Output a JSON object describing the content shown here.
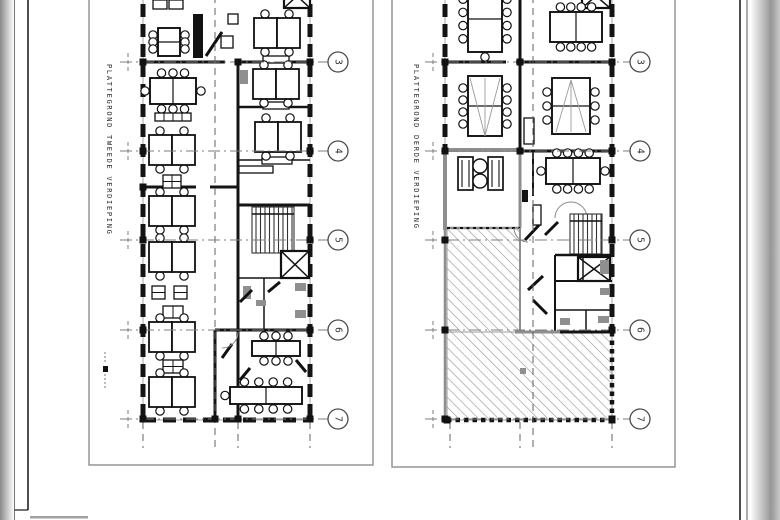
{
  "sheet": {
    "type": "architectural-floorplan-scan",
    "grid_labels": [
      "3",
      "4",
      "5",
      "6",
      "7"
    ]
  },
  "plans": [
    {
      "title": "PLATTEGROND TWEEDE VERDIEPING",
      "frame": {
        "x": 89,
        "y": -16,
        "w": 284,
        "h": 481
      },
      "title_pos": {
        "x": 107,
        "y": 64
      },
      "grid": {
        "ys": [
          62,
          151,
          240,
          330,
          419
        ],
        "labels": [
          "3",
          "4",
          "5",
          "6",
          "7"
        ],
        "x1": 120,
        "x2": 328,
        "bubble_x": 338,
        "tick_x": 128
      },
      "vdash": [
        [
          215,
          -16,
          215,
          448
        ],
        [
          143,
          422,
          143,
          448
        ],
        [
          238,
          422,
          238,
          448
        ],
        [
          310,
          422,
          310,
          448
        ]
      ],
      "nodes": [
        [
          143,
          62
        ],
        [
          310,
          62
        ],
        [
          143,
          151
        ],
        [
          310,
          151
        ],
        [
          143,
          240
        ],
        [
          310,
          240
        ],
        [
          143,
          330
        ],
        [
          310,
          330
        ],
        [
          143,
          419
        ],
        [
          310,
          419
        ],
        [
          238,
          62
        ],
        [
          238,
          419
        ],
        [
          215,
          419
        ],
        [
          143,
          187
        ]
      ],
      "items": [
        [
          "ww",
          143,
          -16,
          143,
          420
        ],
        [
          "ww",
          310,
          -16,
          310,
          420
        ],
        [
          "ww",
          143,
          420,
          310,
          420
        ],
        [
          "w",
          143,
          62,
          225,
          62,
          3
        ],
        [
          "w",
          236,
          62,
          310,
          62,
          3
        ],
        [
          "w",
          238,
          107,
          310,
          107,
          2.5
        ],
        [
          "w",
          238,
          160,
          310,
          160,
          1.5
        ],
        [
          "w",
          143,
          187,
          196,
          187,
          3
        ],
        [
          "w",
          210,
          187,
          238,
          187,
          3
        ],
        [
          "w",
          238,
          62,
          238,
          420,
          3
        ],
        [
          "w",
          215,
          330,
          310,
          330,
          3
        ],
        [
          "w",
          215,
          330,
          215,
          420,
          3
        ],
        [
          "w",
          238,
          205,
          310,
          205,
          3
        ],
        [
          "w",
          238,
          278,
          310,
          278,
          1.5
        ],
        [
          "w",
          264,
          278,
          264,
          330,
          1.5
        ],
        [
          "st",
          252,
          207,
          42,
          46
        ],
        [
          "el",
          281,
          251,
          28,
          27
        ],
        [
          "el",
          284,
          -16,
          26,
          24
        ],
        [
          "fx",
          243,
          286,
          8,
          13
        ],
        [
          "fx",
          295,
          283,
          11,
          8
        ],
        [
          "fx",
          256,
          300,
          10,
          6
        ],
        [
          "fx",
          295,
          310,
          11,
          8
        ],
        [
          "dl",
          240,
          302,
          252,
          290
        ],
        [
          "dl",
          268,
          292,
          280,
          282
        ],
        [
          "fr",
          193,
          14,
          10,
          44,
          "#111"
        ],
        [
          "dl",
          206,
          56,
          222,
          32
        ],
        [
          "r",
          221,
          36,
          12,
          12
        ],
        [
          "r",
          228,
          14,
          10,
          10
        ],
        [
          "fx",
          240,
          70,
          8,
          14
        ],
        [
          "r",
          263,
          56,
          26,
          7
        ],
        [
          "r",
          263,
          102,
          26,
          7
        ],
        [
          "r",
          262,
          157,
          30,
          7
        ],
        [
          "r",
          239,
          166,
          34,
          7
        ],
        [
          "r",
          153,
          0,
          14,
          9
        ],
        [
          "r",
          169,
          0,
          14,
          9
        ],
        [
          "mt",
          158,
          28,
          22,
          28,
          0,
          0,
          3,
          3
        ],
        [
          "desks",
          277,
          33
        ],
        [
          "mt",
          150,
          78,
          46,
          26,
          3,
          3,
          1,
          1
        ],
        [
          "sq",
          155,
          113,
          36,
          8,
          4,
          1
        ],
        [
          "desks",
          276,
          84
        ],
        [
          "desks",
          172,
          150
        ],
        [
          "desks",
          278,
          137
        ],
        [
          "sq",
          163,
          175,
          18,
          13,
          2,
          2
        ],
        [
          "desks",
          172,
          211
        ],
        [
          "desks",
          172,
          257
        ],
        [
          "sq",
          152,
          286,
          13,
          13,
          1,
          2
        ],
        [
          "sq",
          174,
          286,
          13,
          13,
          1,
          2
        ],
        [
          "sq",
          163,
          306,
          20,
          12,
          2,
          1
        ],
        [
          "desks",
          172,
          337
        ],
        [
          "sq",
          163,
          360,
          20,
          13,
          2,
          2
        ],
        [
          "desks",
          172,
          392
        ],
        [
          "mt",
          230,
          387,
          72,
          17,
          4,
          4,
          1,
          0
        ],
        [
          "mt",
          252,
          341,
          48,
          15,
          3,
          3,
          0,
          0
        ],
        [
          "dl",
          222,
          358,
          232,
          344
        ],
        [
          "dl",
          240,
          380,
          250,
          368
        ],
        [
          "dl",
          296,
          360,
          306,
          372
        ],
        [
          "arc",
          222,
          332,
          16,
          0,
          90
        ],
        [
          "fr",
          103,
          366,
          5,
          6,
          "#111"
        ],
        [
          "tick",
          105,
          352,
          105,
          364
        ],
        [
          "tick",
          105,
          374,
          105,
          388
        ]
      ]
    },
    {
      "title": "PLATTEGROND DERDE VERDIEPING",
      "frame": {
        "x": 392,
        "y": -16,
        "w": 283,
        "h": 483
      },
      "title_pos": {
        "x": 414,
        "y": 64
      },
      "grid": {
        "ys": [
          62,
          151,
          240,
          330,
          419
        ],
        "labels": [
          "3",
          "4",
          "5",
          "6",
          "7"
        ],
        "x1": 425,
        "x2": 630,
        "bubble_x": 640,
        "tick_x": 433
      },
      "vdash": [
        [
          533,
          -16,
          533,
          448
        ],
        [
          450,
          422,
          450,
          448
        ],
        [
          520,
          422,
          520,
          448
        ],
        [
          612,
          422,
          612,
          448
        ]
      ],
      "nodes": [
        [
          445,
          62
        ],
        [
          612,
          62
        ],
        [
          445,
          151
        ],
        [
          612,
          151
        ],
        [
          445,
          240
        ],
        [
          612,
          240
        ],
        [
          445,
          330
        ],
        [
          612,
          330
        ],
        [
          445,
          419
        ],
        [
          612,
          419
        ],
        [
          520,
          62
        ],
        [
          520,
          151
        ],
        [
          447,
          420
        ],
        [
          612,
          420
        ]
      ],
      "items": [
        [
          "hx",
          447,
          228,
          73,
          104
        ],
        [
          "hx",
          447,
          332,
          165,
          88
        ],
        [
          "ww",
          445,
          -16,
          445,
          150
        ],
        [
          "gw",
          445,
          150,
          445,
          230,
          4
        ],
        [
          "gw",
          445,
          228,
          445,
          420,
          2.5
        ],
        [
          "ww",
          612,
          -16,
          612,
          330
        ],
        [
          "w",
          520,
          -16,
          520,
          151,
          3
        ],
        [
          "w",
          445,
          62,
          506,
          62,
          3
        ],
        [
          "w",
          516,
          62,
          612,
          62,
          3
        ],
        [
          "gw",
          445,
          150,
          520,
          150,
          4
        ],
        [
          "w",
          520,
          151,
          612,
          151,
          3
        ],
        [
          "gw",
          520,
          150,
          520,
          228,
          3
        ],
        [
          "w",
          533,
          151,
          533,
          196,
          2
        ],
        [
          "gw",
          445,
          228,
          520,
          228,
          2.5
        ],
        [
          "dt",
          447,
          228,
          520,
          228
        ],
        [
          "gw",
          520,
          228,
          520,
          332,
          2
        ],
        [
          "arc",
          571,
          218,
          16,
          180,
          360
        ],
        [
          "st",
          570,
          214,
          32,
          40
        ],
        [
          "w",
          555,
          255,
          612,
          255,
          2.5
        ],
        [
          "el",
          578,
          257,
          32,
          24
        ],
        [
          "el",
          582,
          -16,
          28,
          24
        ],
        [
          "w",
          555,
          255,
          555,
          332,
          2
        ],
        [
          "w",
          555,
          281,
          612,
          281,
          2
        ],
        [
          "w",
          583,
          255,
          583,
          281,
          1.5
        ],
        [
          "w",
          555,
          310,
          612,
          310,
          1.5
        ],
        [
          "w",
          586,
          310,
          586,
          332,
          1.5
        ],
        [
          "gw",
          515,
          332,
          560,
          332,
          3
        ],
        [
          "w",
          560,
          332,
          612,
          332,
          3
        ],
        [
          "dw",
          447,
          420,
          612,
          420
        ],
        [
          "dw",
          612,
          332,
          612,
          420
        ],
        [
          "fx",
          600,
          260,
          9,
          14
        ],
        [
          "fx",
          600,
          288,
          10,
          7
        ],
        [
          "fx",
          598,
          316,
          11,
          7
        ],
        [
          "fx",
          560,
          318,
          10,
          7
        ],
        [
          "dl",
          525,
          240,
          540,
          224
        ],
        [
          "dl",
          545,
          235,
          558,
          222
        ],
        [
          "dl",
          528,
          290,
          543,
          276
        ],
        [
          "dl",
          533,
          300,
          547,
          314
        ],
        [
          "arc",
          528,
          228,
          14,
          90,
          180
        ],
        [
          "r",
          524,
          118,
          10,
          26
        ],
        [
          "r",
          533,
          205,
          8,
          20
        ],
        [
          "fr",
          522,
          190,
          6,
          12,
          "#111"
        ],
        [
          "mt",
          468,
          -14,
          34,
          66,
          0,
          1,
          4,
          4
        ],
        [
          "mt",
          468,
          76,
          34,
          60,
          0,
          0,
          4,
          4
        ],
        [
          "cone",
          485,
          136,
          470,
          78,
          500,
          78
        ],
        [
          "mt",
          550,
          12,
          52,
          30,
          4,
          4,
          0,
          0
        ],
        [
          "mt",
          552,
          78,
          38,
          56,
          0,
          0,
          3,
          3
        ],
        [
          "cone",
          571,
          80,
          556,
          132,
          586,
          132
        ],
        [
          "ac",
          458,
          157,
          15,
          33
        ],
        [
          "ac",
          488,
          157,
          15,
          33
        ],
        [
          "ct",
          480,
          166,
          7
        ],
        [
          "ct",
          480,
          181,
          7
        ],
        [
          "mt",
          546,
          158,
          54,
          26,
          4,
          4,
          1,
          1
        ],
        [
          "fx",
          520,
          368,
          6,
          6
        ]
      ]
    }
  ]
}
